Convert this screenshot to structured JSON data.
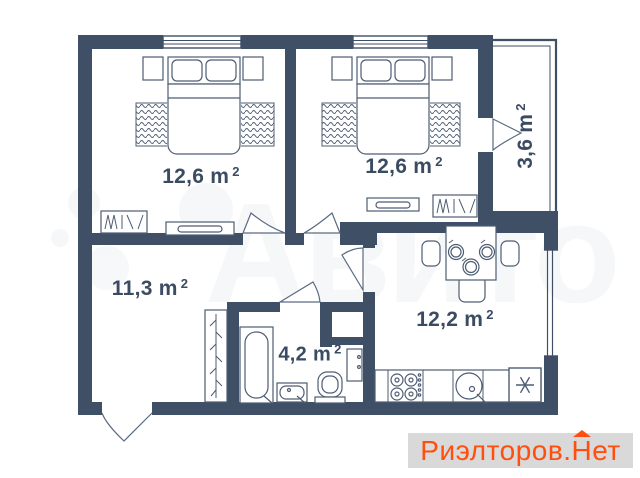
{
  "plan": {
    "rooms": [
      {
        "id": "bedroom-1",
        "area": "12,6",
        "unit": "m",
        "sup": "2"
      },
      {
        "id": "bedroom-2",
        "area": "12,6",
        "unit": "m",
        "sup": "2"
      },
      {
        "id": "hallway",
        "area": "11,3",
        "unit": "m",
        "sup": "2"
      },
      {
        "id": "bathroom",
        "area": "4,2",
        "unit": "m",
        "sup": "2"
      },
      {
        "id": "kitchen",
        "area": "12,2",
        "unit": "m",
        "sup": "2"
      },
      {
        "id": "balcony",
        "area": "3,6",
        "unit": "m",
        "sup": "2"
      }
    ]
  },
  "watermarks": {
    "center_logo_text": "Авито",
    "footer": {
      "part1": "Риэлторов.",
      "part2": "Н",
      "part3": "ет"
    }
  },
  "colors": {
    "wall": "#3f4f66",
    "furniture_line": "#4e5d73",
    "label": "#3b4b61",
    "accent": "#ff4e0d",
    "watermark_bar": "#d9d9d9"
  }
}
